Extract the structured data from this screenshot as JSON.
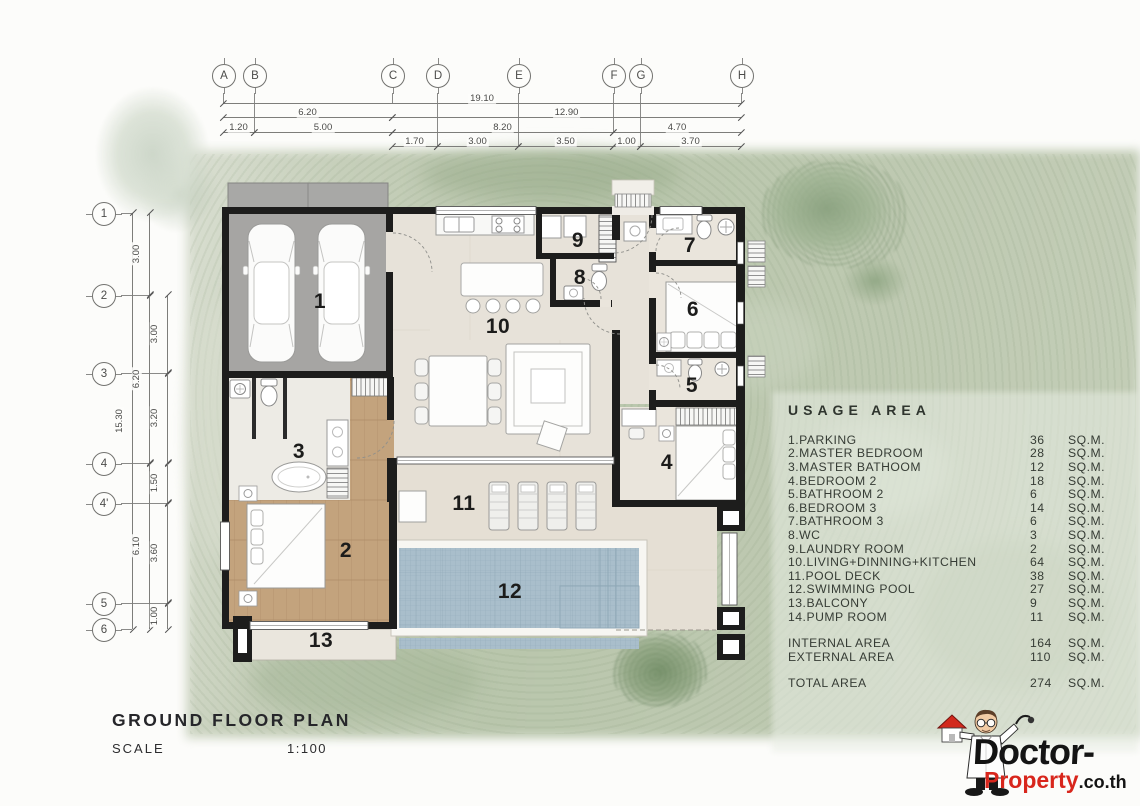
{
  "page": {
    "title": "GROUND FLOOR PLAN",
    "scale_label": "SCALE",
    "scale_value": "1:100"
  },
  "grid_markers": {
    "top": [
      "A",
      "B",
      "C",
      "D",
      "E",
      "F",
      "G",
      "H"
    ],
    "left": [
      "1",
      "2",
      "3",
      "4",
      "4'",
      "5",
      "6"
    ]
  },
  "dimensions": {
    "top_row1": [
      "19.10"
    ],
    "top_row2": [
      "6.20",
      "12.90"
    ],
    "top_row3": [
      "1.20",
      "5.00",
      "8.20",
      "4.70"
    ],
    "top_row4": [
      "1.70",
      "3.00",
      "3.50",
      "1.00",
      "3.70"
    ],
    "left_col1": [
      "15.30"
    ],
    "left_col2": [
      "3.00",
      "6.20",
      "6.10"
    ],
    "left_col3": [
      "3.00",
      "3.20",
      "1.50",
      "3.60",
      "1.00"
    ]
  },
  "room_labels": [
    "1",
    "2",
    "3",
    "4",
    "5",
    "6",
    "7",
    "8",
    "9",
    "10",
    "11",
    "12",
    "13"
  ],
  "usage_table": {
    "title": "USAGE AREA",
    "rows": [
      {
        "name": "1.PARKING",
        "value": "36",
        "unit": "SQ.M."
      },
      {
        "name": "2.MASTER BEDROOM",
        "value": "28",
        "unit": "SQ.M."
      },
      {
        "name": "3.MASTER BATHOOM",
        "value": "12",
        "unit": "SQ.M."
      },
      {
        "name": "4.BEDROOM 2",
        "value": "18",
        "unit": "SQ.M."
      },
      {
        "name": "5.BATHROOM 2",
        "value": "6",
        "unit": "SQ.M."
      },
      {
        "name": "6.BEDROOM 3",
        "value": "14",
        "unit": "SQ.M."
      },
      {
        "name": "7.BATHROOM 3",
        "value": "6",
        "unit": "SQ.M."
      },
      {
        "name": "8.WC",
        "value": "3",
        "unit": "SQ.M."
      },
      {
        "name": "9.LAUNDRY ROOM",
        "value": "2",
        "unit": "SQ.M."
      },
      {
        "name": "10.LIVING+DINNING+KITCHEN",
        "value": "64",
        "unit": "SQ.M."
      },
      {
        "name": "11.POOL DECK",
        "value": "38",
        "unit": "SQ.M."
      },
      {
        "name": "12.SWIMMING POOL",
        "value": "27",
        "unit": "SQ.M."
      },
      {
        "name": "13.BALCONY",
        "value": "9",
        "unit": "SQ.M."
      },
      {
        "name": "14.PUMP ROOM",
        "value": "11",
        "unit": "SQ.M."
      }
    ],
    "summary": [
      {
        "name": "INTERNAL AREA",
        "value": "164",
        "unit": "SQ.M."
      },
      {
        "name": "EXTERNAL AREA",
        "value": "110",
        "unit": "SQ.M."
      }
    ],
    "total": {
      "name": "TOTAL AREA",
      "value": "274",
      "unit": "SQ.M."
    }
  },
  "logo": {
    "brand_black": "Doctor-",
    "brand_red": "Property",
    "brand_suffix": ".co.th"
  },
  "icons": {
    "mascot": "doctor-mascot",
    "mascot_house": "house-icon"
  },
  "colors": {
    "accent_red": "#d8261c",
    "wall_black": "#1d1d1c",
    "pool_blue": "#a9becb",
    "wood_floor": "#c3a37d",
    "lawn_green": "#bcc8b0"
  }
}
